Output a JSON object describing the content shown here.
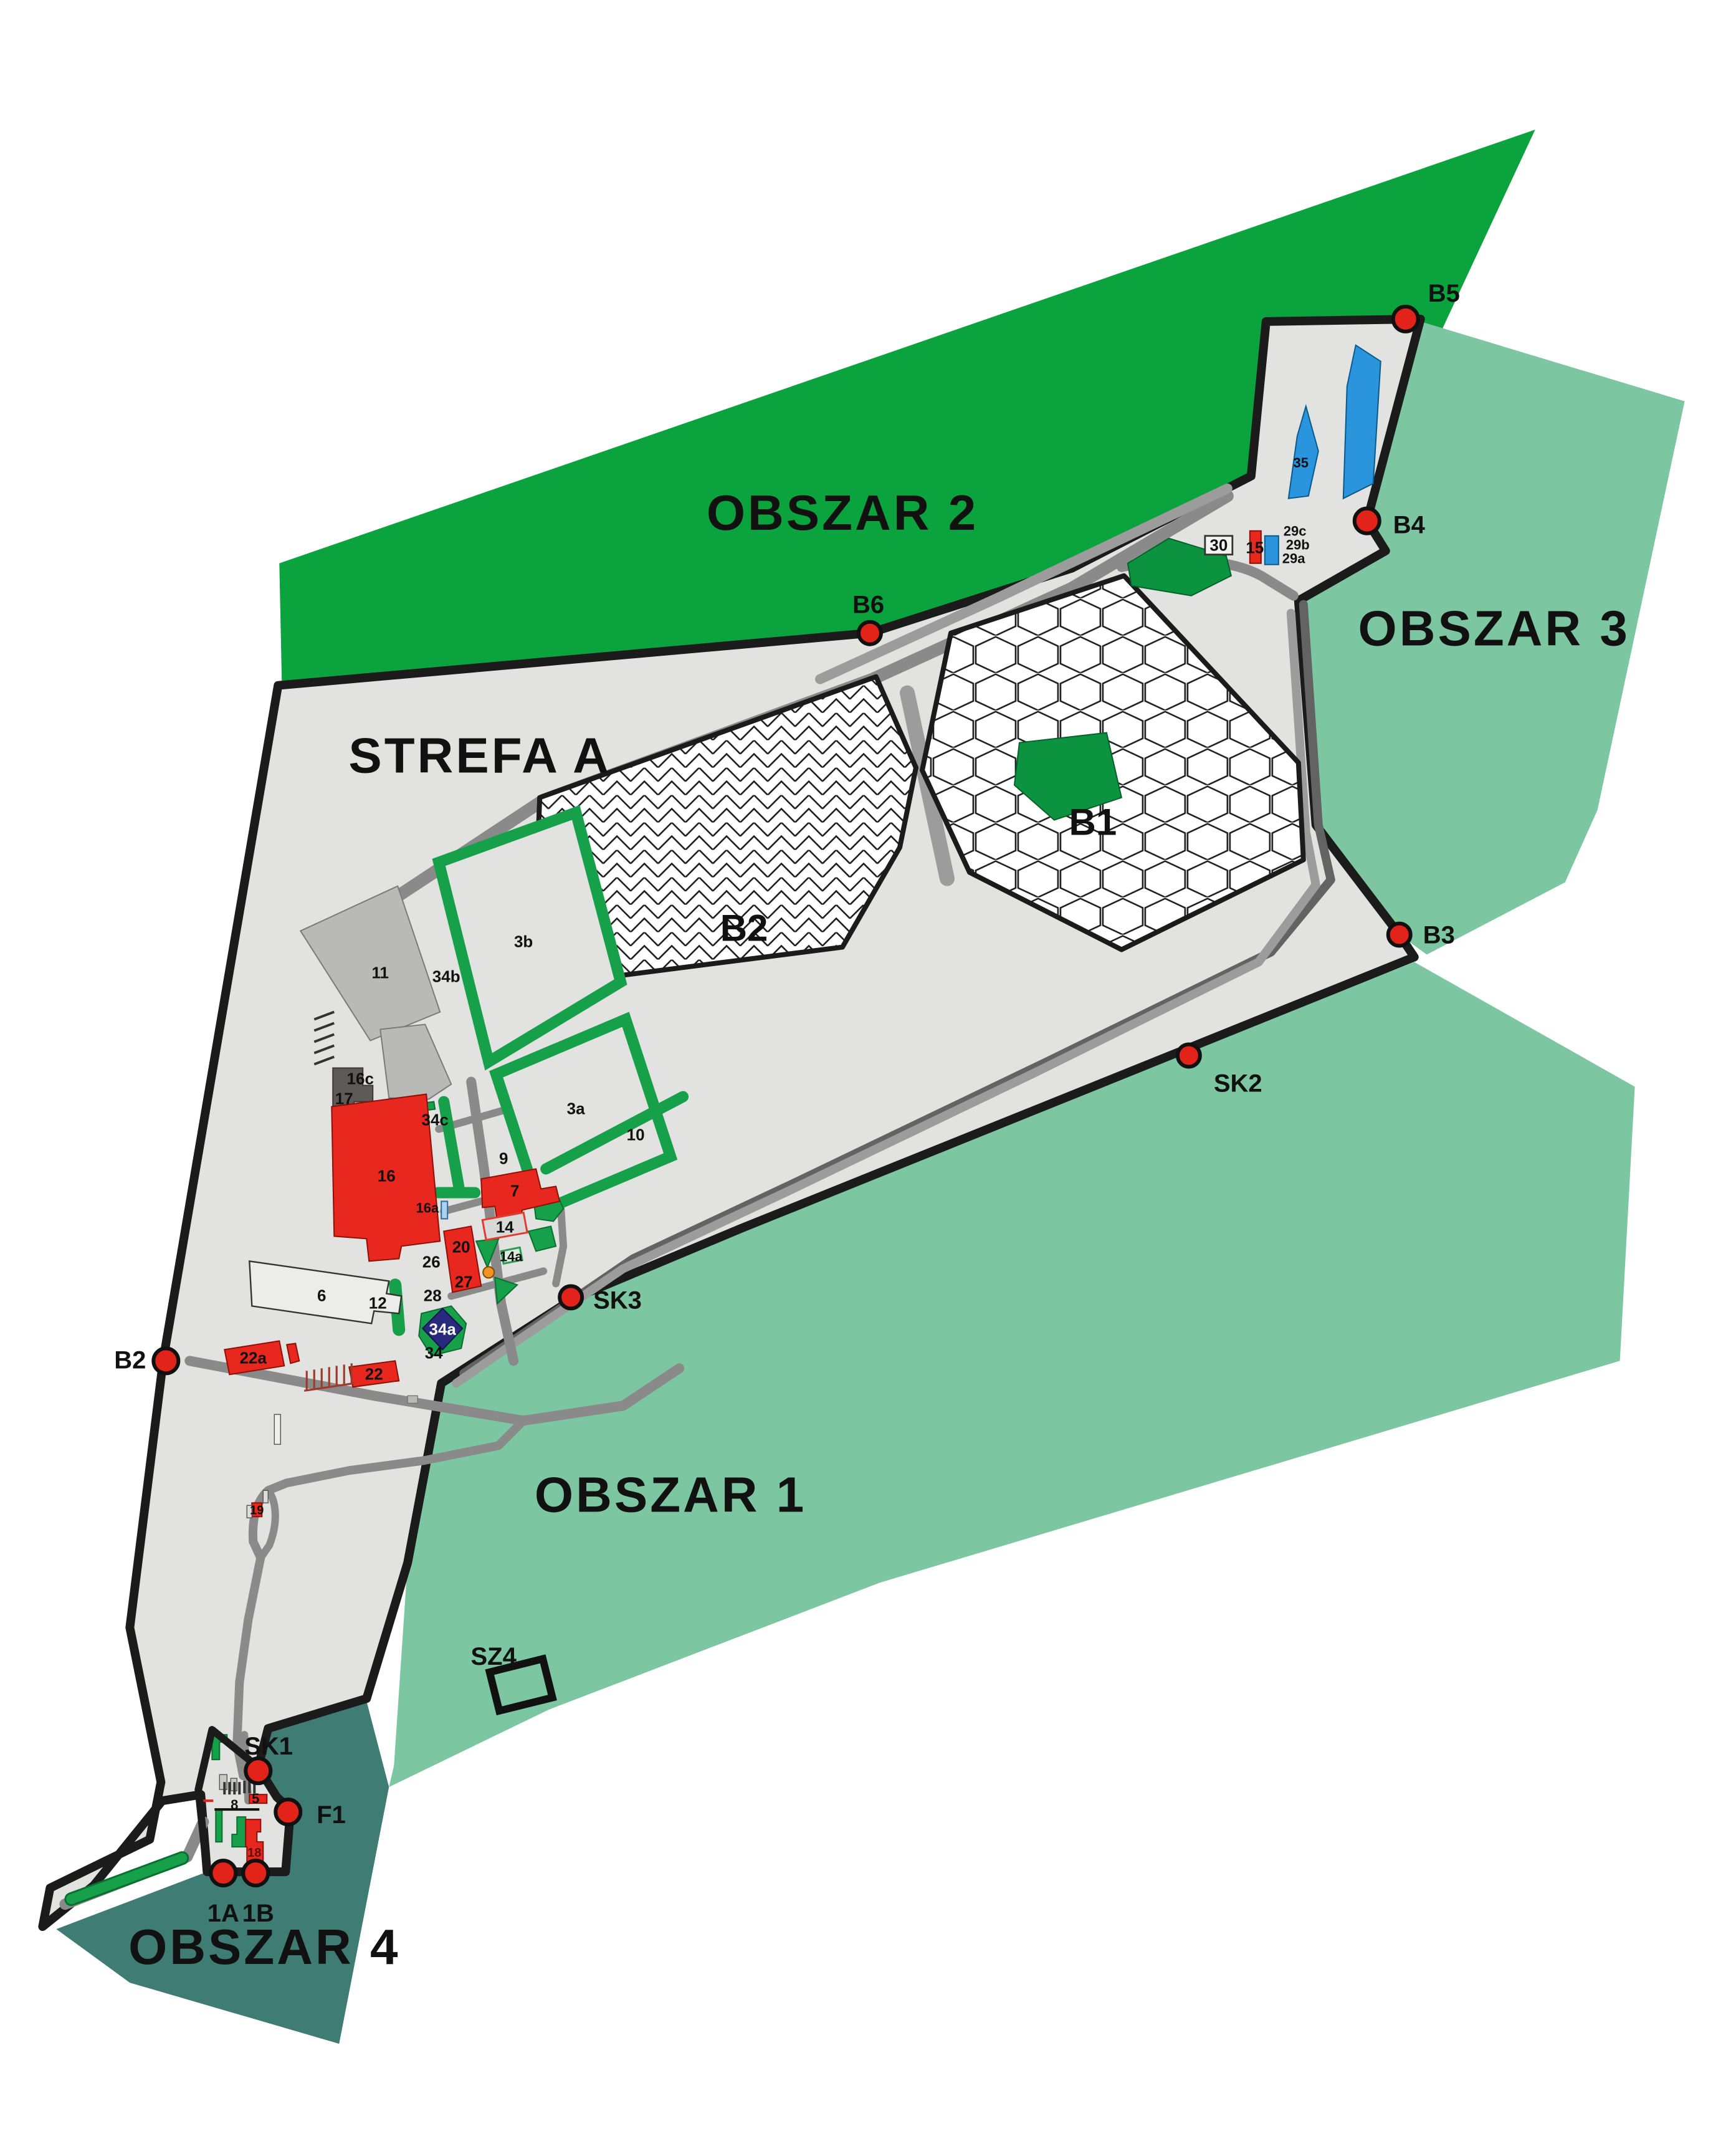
{
  "title": "Site zoning map",
  "colors": {
    "areaDark": "#0aa33e",
    "areaLight": "#7cc7a1",
    "areaTeal": "#3e7c74",
    "zoneGray": "#e2e2e0",
    "road": "#8a8a8a",
    "roadDark": "#636363",
    "roadLight": "#9c9c9c",
    "building": "#e8281e",
    "green": "#17a04a",
    "blue": "#2a94dd",
    "navy": "#282a7e",
    "marker": "#e2231a",
    "orange": "#f0941f"
  },
  "areas": {
    "obszar1": "OBSZAR 1",
    "obszar2": "OBSZAR 2",
    "obszar3": "OBSZAR 3",
    "obszar4": "OBSZAR 4",
    "strefa": "STREFA A"
  },
  "plots": {
    "b1": "B1",
    "b2": "B2"
  },
  "markers": {
    "b2": "B2",
    "b3": "B3",
    "b4": "B4",
    "b5": "B5",
    "b6": "B6",
    "sk1": "SK1",
    "sk2": "SK2",
    "sk3": "SK3",
    "f1": "F1",
    "p1a": "1A",
    "p1b": "1B",
    "sz4": "SZ4"
  },
  "buildings": {
    "n3a": "3a",
    "n3b": "3b",
    "n5": "5",
    "n6": "6",
    "n7": "7",
    "n8": "8",
    "n9": "9",
    "n10": "10",
    "n11": "11",
    "n12": "12",
    "n14": "14",
    "n14a": "14a",
    "n15": "15",
    "n16": "16",
    "n16a": "16a",
    "n16c": "16c",
    "n17": "17",
    "n18": "18",
    "n19": "19",
    "n20": "20",
    "n22": "22",
    "n22a": "22a",
    "n26": "26",
    "n27": "27",
    "n28": "28",
    "n29a": "29a",
    "n29b": "29b",
    "n29c": "29c",
    "n30": "30",
    "n34": "34",
    "n34a": "34a",
    "n34b": "34b",
    "n34c": "34c",
    "n35": "35"
  }
}
